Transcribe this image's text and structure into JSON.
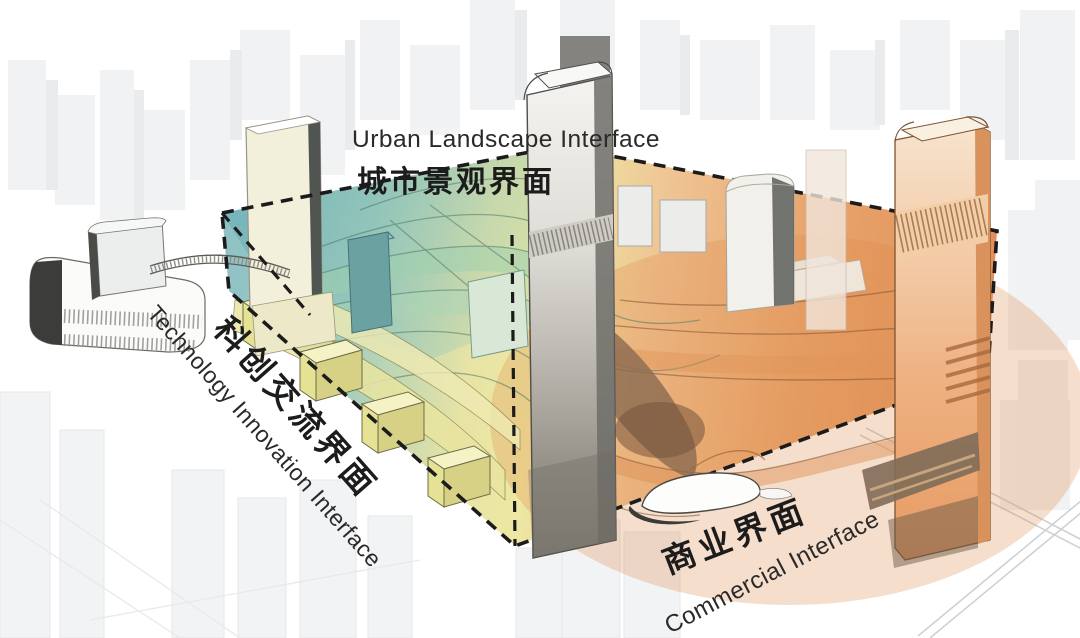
{
  "diagram": {
    "type": "architectural-axonometric-concept",
    "interfaces": [
      {
        "id": "urban-landscape",
        "zh": "城市景观界面",
        "en": "Urban Landscape Interface",
        "color": "#8fc3c6",
        "position": "top"
      },
      {
        "id": "technology-innovation",
        "zh": "科创交流界面",
        "en": "Technology Innovation Interface",
        "color": "#ebe6a2",
        "position": "left"
      },
      {
        "id": "commercial",
        "zh": "商业界面",
        "en": "Commercial Interface",
        "color": "#e59a62",
        "position": "bottom-right"
      }
    ],
    "colors": {
      "teal": "#86bdbf",
      "green": "#a5cfb9",
      "yellow": "#ece79e",
      "orange_light": "#f0c192",
      "orange_deep": "#df8a50",
      "dashed_outline": "#1b1b1b",
      "text": "#262626",
      "context_grey": "#e8eaec"
    }
  }
}
